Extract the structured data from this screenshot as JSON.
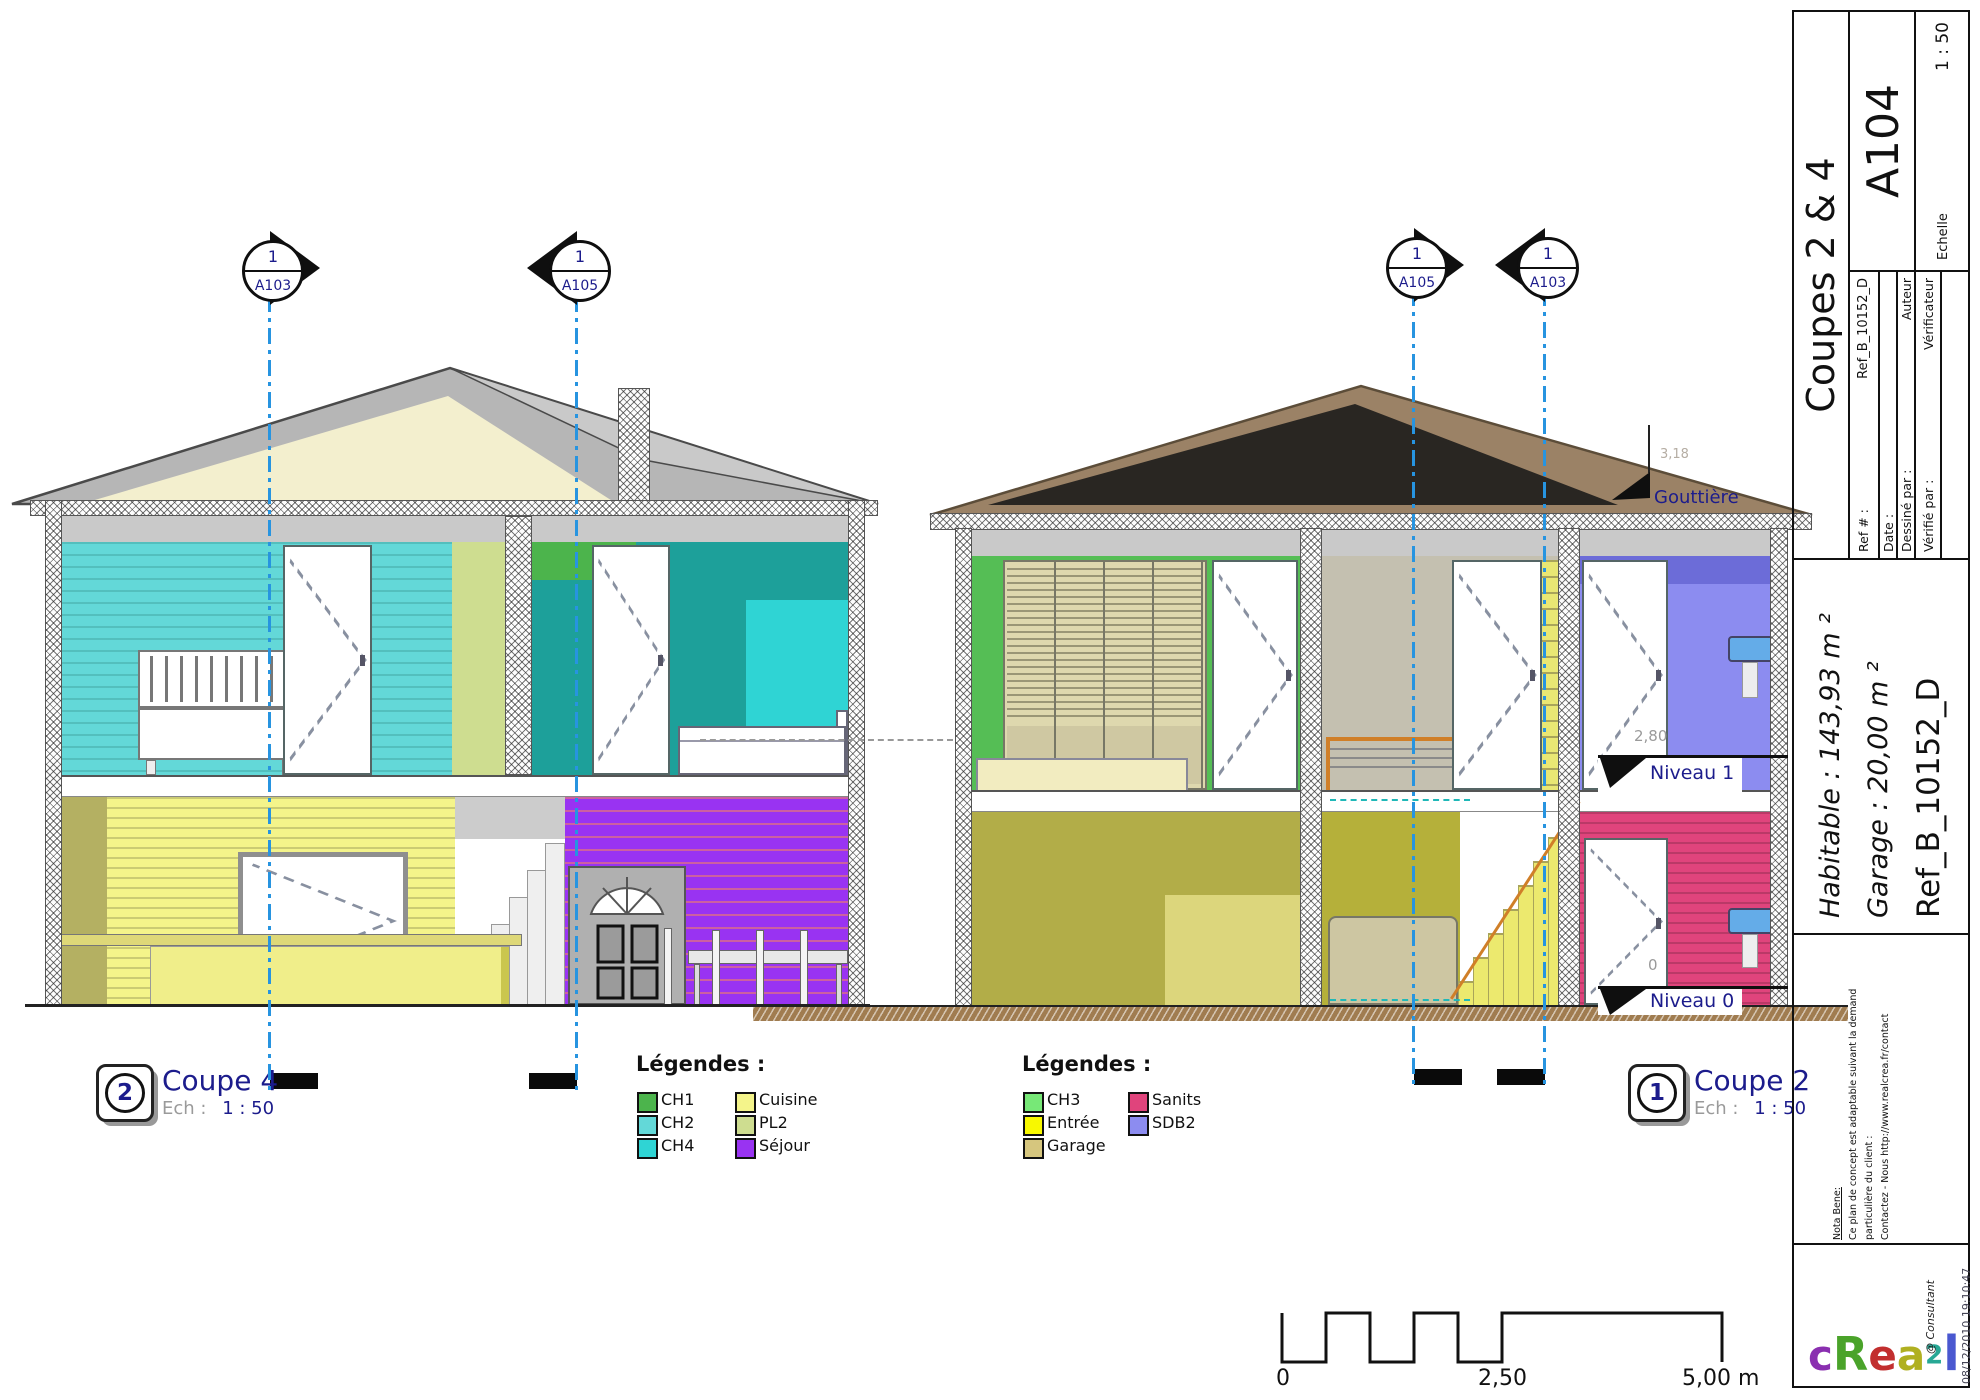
{
  "markers": {
    "left": [
      {
        "number": "1",
        "sheet": "A103"
      },
      {
        "number": "1",
        "sheet": "A105"
      }
    ],
    "right": [
      {
        "number": "1",
        "sheet": "A105"
      },
      {
        "number": "1",
        "sheet": "A103"
      }
    ]
  },
  "legend_left": {
    "title": "Légendes :",
    "items": [
      {
        "label": "CH1",
        "color": "#4cb44c"
      },
      {
        "label": "CH2",
        "color": "#63d8d8"
      },
      {
        "label": "CH4",
        "color": "#2fd4d4"
      },
      {
        "label": "Cuisine",
        "color": "#f4f48a"
      },
      {
        "label": "PL2",
        "color": "#cedd90"
      },
      {
        "label": "Séjour",
        "color": "#9933f2"
      }
    ]
  },
  "legend_right": {
    "title": "Légendes :",
    "items": [
      {
        "label": "CH3",
        "color": "#77e877"
      },
      {
        "label": "Entrée",
        "color": "#f8f800"
      },
      {
        "label": "Garage",
        "color": "#d6c67e"
      },
      {
        "label": "Sanits",
        "color": "#e0447c"
      },
      {
        "label": "SDB2",
        "color": "#8c8cf0"
      }
    ]
  },
  "views": {
    "coupe4": {
      "number": "2",
      "title": "Coupe 4",
      "scale_label": "Ech :",
      "scale": "1 : 50"
    },
    "coupe2": {
      "number": "1",
      "title": "Coupe 2",
      "scale_label": "Ech :",
      "scale": "1 : 50"
    }
  },
  "annotations": {
    "gouttiere": "Gouttière",
    "niveau1": "Niveau 1",
    "niveau0": "Niveau 0",
    "dim_level1": "2,80",
    "dim_level0": "0",
    "dim_roof": "3,18"
  },
  "scale_bar": {
    "start": "0",
    "mid": "2,50",
    "end": "5,00 m"
  },
  "title_block": {
    "title": "Coupes 2 & 4",
    "sheet_number": "A104",
    "scale_label": "Echelle",
    "scale": "1 : 50",
    "fields": [
      {
        "label": "Ref # :",
        "value": "Ref_B_10152_D"
      },
      {
        "label": "Date :",
        "value": ""
      },
      {
        "label": "Dessiné par :",
        "value": "Auteur"
      },
      {
        "label": "Vérifié par :",
        "value": "Vérificateur"
      }
    ],
    "area_habitable": "Habitable : 143,93 m ²",
    "area_garage": "Garage : 20,00 m ²",
    "reference": "Ref_B_10152_D",
    "nota": {
      "heading": "Nota Bene:",
      "line1": "Ce plan de concept est adaptable suivant la demande",
      "line2": "particulière du client :",
      "line3": "Contactez - Nous http://www.realcrea.fr/contact"
    },
    "logo": {
      "letters": [
        {
          "ch": "c",
          "color": "#8a2fb0"
        },
        {
          "ch": "R",
          "color": "#4aa32a"
        },
        {
          "ch": "e",
          "color": "#c22f2f"
        },
        {
          "ch": "a",
          "color": "#b0b021"
        },
        {
          "ch": "2",
          "color": "#27a895"
        },
        {
          "ch": "l",
          "color": "#4a58d0"
        }
      ],
      "consultant": "@ Consultant"
    },
    "timestamp": "08/12/2010 19:10:47"
  }
}
